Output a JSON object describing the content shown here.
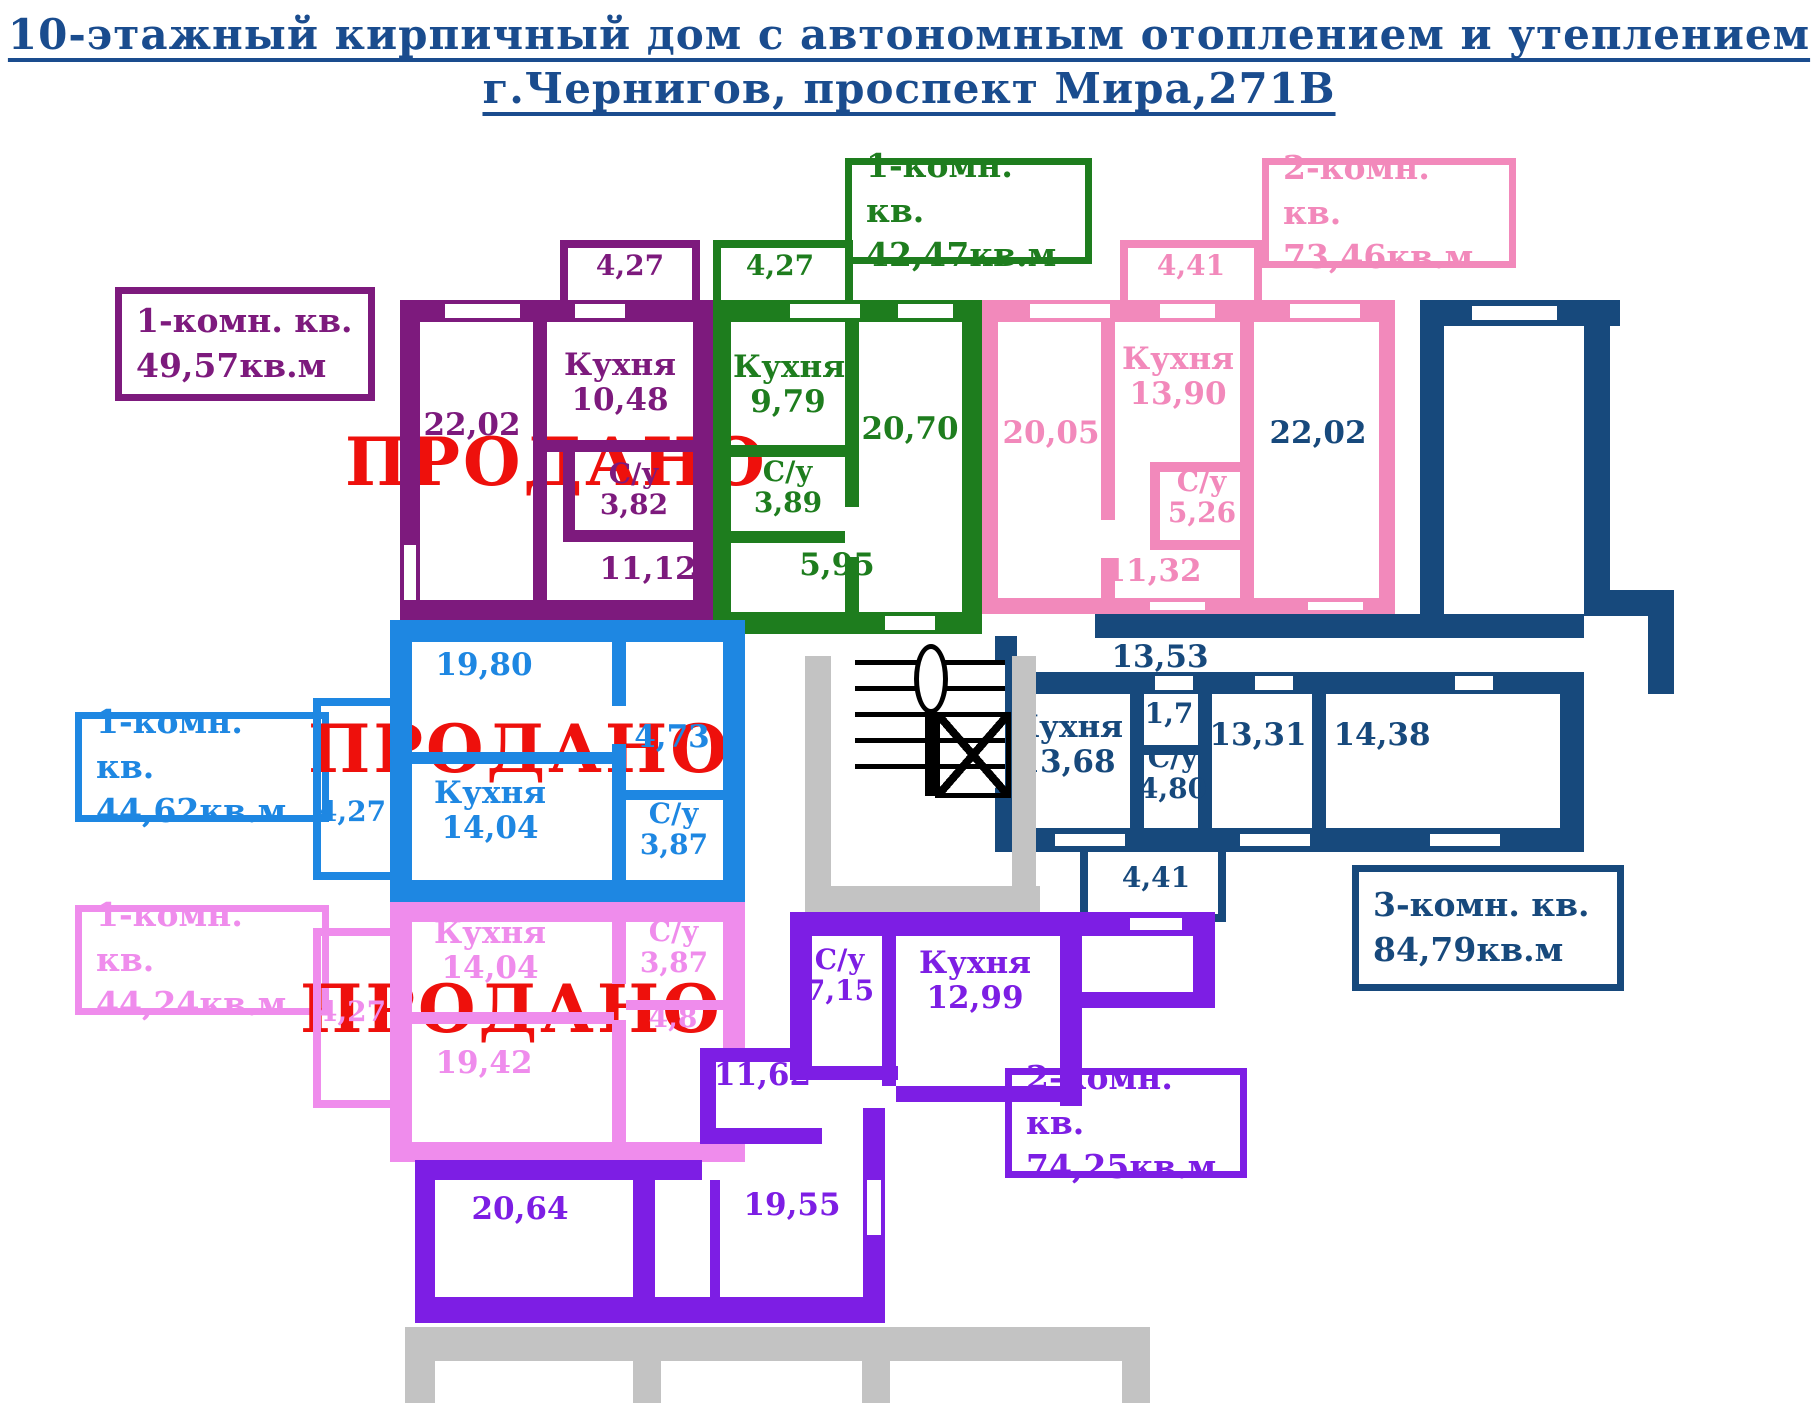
{
  "title": {
    "line1": "10-этажный кирпичный дом с автономным отоплением и утеплением",
    "line2": "г.Чернигов, проспект Мира,271В"
  },
  "sold_stamp": "ПРОДАНО",
  "room_names": {
    "kitchen": "Кухня",
    "bathroom": "С/у"
  },
  "palette": {
    "title_blue": "#1a4c8e",
    "sold_red": "#ee100c",
    "purple": "#7d1a7d",
    "green": "#1e7d1e",
    "pink": "#f289bb",
    "navy": "#17497c",
    "blue": "#1e87e2",
    "light_pink": "#ef8cec",
    "violet": "#7d1ee4",
    "grey_base": "#c3c3c3"
  },
  "apartments": {
    "purple": {
      "type": "1-комн. кв.",
      "area": "49,57кв.м",
      "sold": true,
      "rooms": {
        "balcony": "4,27",
        "living": "22,02",
        "kitchen": "10,48",
        "bathroom": "3,82",
        "hall": "11,12"
      }
    },
    "green": {
      "type": "1-комн. кв.",
      "area": "42,47кв.м",
      "sold": false,
      "rooms": {
        "balcony": "4,27",
        "kitchen": "9,79",
        "bathroom": "3,89",
        "living": "20,70",
        "hall": "5,95"
      }
    },
    "pink": {
      "type": "2-комн. кв.",
      "area": "73,46кв.м",
      "sold": false,
      "rooms": {
        "balcony": "4,41",
        "living1": "20,05",
        "kitchen": "13,90",
        "bathroom": "5,26",
        "hall": "11,32",
        "living2": "22,02"
      }
    },
    "navy": {
      "type": "3-комн. кв.",
      "area": "84,79кв.м",
      "sold": false,
      "rooms": {
        "living1": "22,02",
        "hall": "13,53",
        "kitchen": "13,68",
        "closet": "1,7",
        "bathroom": "4,80",
        "living2": "13,31",
        "living3": "14,38",
        "balcony": "4,41"
      }
    },
    "blue": {
      "type": "1-комн. кв.",
      "area": "44,62кв.м",
      "sold": true,
      "rooms": {
        "living": "19,80",
        "hall": "4,73",
        "balcony": "4,27",
        "kitchen": "14,04",
        "bathroom": "3,87"
      }
    },
    "light_pink": {
      "type": "1-комн. кв.",
      "area": "44,24кв.м",
      "sold": true,
      "rooms": {
        "balcony": "4,27",
        "kitchen": "14,04",
        "bathroom": "3,87",
        "hall": "4,8",
        "living": "19,42"
      }
    },
    "violet": {
      "type": "2-комн. кв.",
      "area": "74,25кв.м",
      "sold": false,
      "rooms": {
        "bathroom": "7,15",
        "kitchen": "12,99",
        "hall": "11,62",
        "living1": "19,55",
        "living2": "20,64"
      }
    }
  }
}
